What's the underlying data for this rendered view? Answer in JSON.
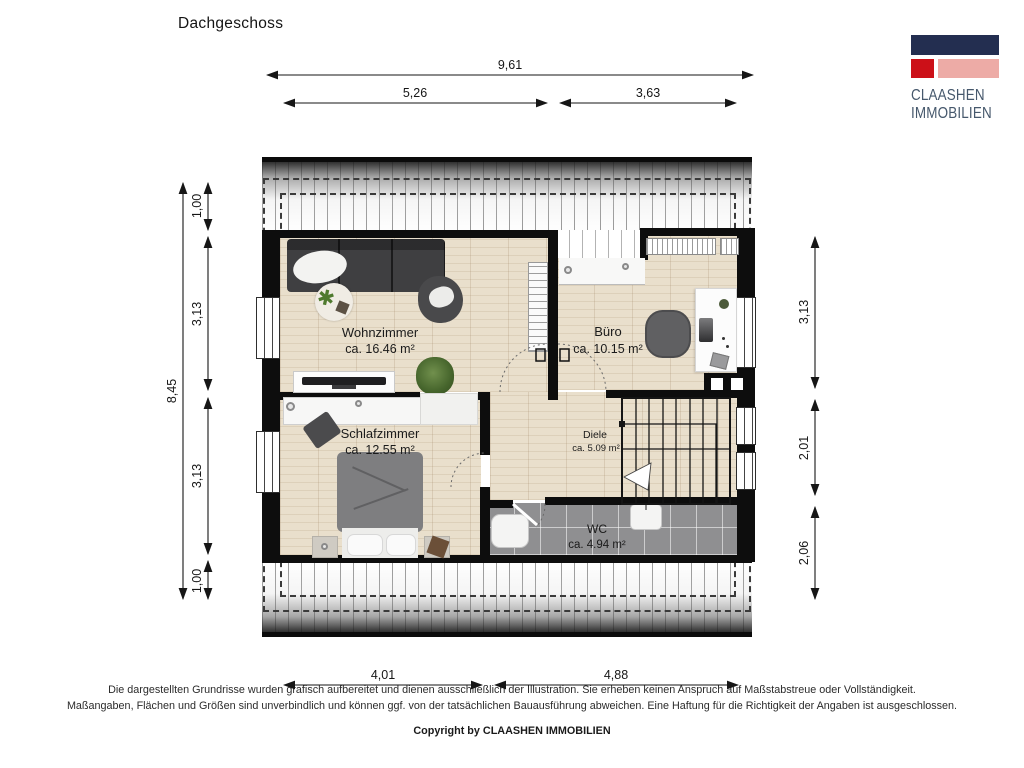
{
  "page": {
    "title": "Dachgeschoss"
  },
  "logo": {
    "line1": "CLAASHEN",
    "line2": "IMMOBILIEN",
    "colors": {
      "navy": "#232e50",
      "red": "#cc1018",
      "pink": "#edaba6",
      "text": "#46586c"
    }
  },
  "dims": {
    "top_total": "9,61",
    "top_left": "5,26",
    "top_right": "3,63",
    "left_total": "8,45",
    "left_segments": [
      "1,00",
      "3,13",
      "3,13",
      "1,00"
    ],
    "right_segments": [
      "3,13",
      "2,01",
      "2,06"
    ],
    "bottom_left": "4,01",
    "bottom_right": "4,88"
  },
  "rooms": {
    "wohnzimmer": {
      "name": "Wohnzimmer",
      "area": "ca. 16.46 m²"
    },
    "buero": {
      "name": "Büro",
      "area": "ca. 10.15 m²"
    },
    "schlafzimmer": {
      "name": "Schlafzimmer",
      "area": "ca. 12.55 m²"
    },
    "diele": {
      "name": "Diele",
      "area": "ca. 5.09 m²"
    },
    "wc": {
      "name": "WC",
      "area": "ca. 4.94 m²"
    }
  },
  "footer": {
    "disclaimer_line1": "Die dargestellten Grundrisse wurden grafisch aufbereitet und dienen ausschließlich der Illustration. Sie erheben keinen Anspruch auf Maßstabstreue oder Vollständigkeit.",
    "disclaimer_line2": "Maßangaben, Flächen und Größen sind unverbindlich und können ggf. von der tatsächlichen Bauausführung abweichen. Eine Haftung für die Richtigkeit der Angaben ist ausgeschlossen.",
    "copyright": "Copyright by CLAASHEN IMMOBILIEN"
  }
}
